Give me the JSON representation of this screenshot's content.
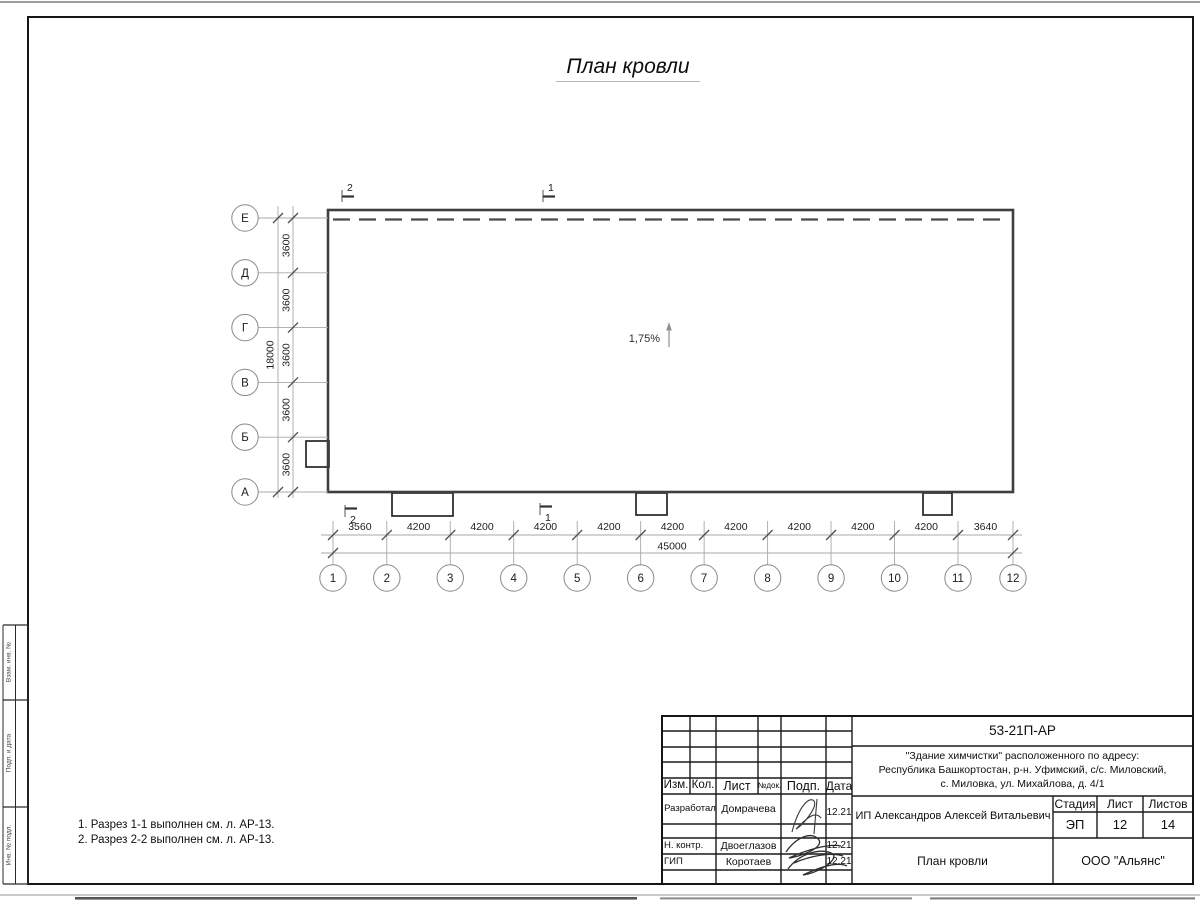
{
  "drawing": {
    "title": "План кровли",
    "slope_label": "1,75%",
    "section_marks": {
      "top": [
        "2",
        "1"
      ],
      "bottom": [
        "2",
        "1"
      ]
    },
    "axes_vertical": {
      "letters": [
        "Е",
        "Д",
        "Г",
        "В",
        "Б",
        "А"
      ],
      "segment_dims": [
        "3600",
        "3600",
        "3600",
        "3600",
        "3600"
      ],
      "total_dim": "18000"
    },
    "axes_horizontal": {
      "numbers": [
        "1",
        "2",
        "3",
        "4",
        "5",
        "6",
        "7",
        "8",
        "9",
        "10",
        "11",
        "12"
      ],
      "segment_dims": [
        "3560",
        "4200",
        "4200",
        "4200",
        "4200",
        "4200",
        "4200",
        "4200",
        "4200",
        "4200",
        "3640"
      ],
      "segment_mm": [
        3560,
        4200,
        4200,
        4200,
        4200,
        4200,
        4200,
        4200,
        4200,
        4200,
        3640
      ],
      "total_dim": "45000",
      "total_mm": 45000
    }
  },
  "notes": [
    "1. Разрез 1-1 выполнен см. л. АР-13.",
    "2. Разрез 2-2 выполнен см. л. АР-13."
  ],
  "side_strip": {
    "labels": [
      "Взам. инв. №",
      "Подп. и дата",
      "Инв. № подл."
    ]
  },
  "titleblock": {
    "doc_number": "53-21П-АР",
    "address_lines": [
      "\"Здание химчистки\" расположенного по адресу:",
      "Республика Башкортостан, р-н. Уфимский, с/с. Миловский,",
      "с. Миловка, ул. Михайлова, д. 4/1"
    ],
    "columns": [
      "Изм.",
      "Кол.",
      "Лист",
      "№док.",
      "Подп.",
      "Дата"
    ],
    "signers": [
      {
        "role": "Разработал",
        "name": "Домрачева",
        "date": "12.21"
      },
      {
        "role": "Н. контр.",
        "name": "Двоеглазов",
        "date": "12.21"
      },
      {
        "role": "ГИП",
        "name": "Коротаев",
        "date": "12.21"
      }
    ],
    "client": "ИП Александров Алексей Витальевич",
    "stage_headers": [
      "Стадия",
      "Лист",
      "Листов"
    ],
    "stage_values": [
      "ЭП",
      "12",
      "14"
    ],
    "sheet_title": "План кровли",
    "company": "ООО \"Альянс\""
  },
  "colors": {
    "wall_line": "#3f3f3f",
    "thin_line": "#a8a8a8",
    "frame_line": "#151515",
    "tick_line": "#4f4f4f",
    "text": "#1d1d1d"
  }
}
